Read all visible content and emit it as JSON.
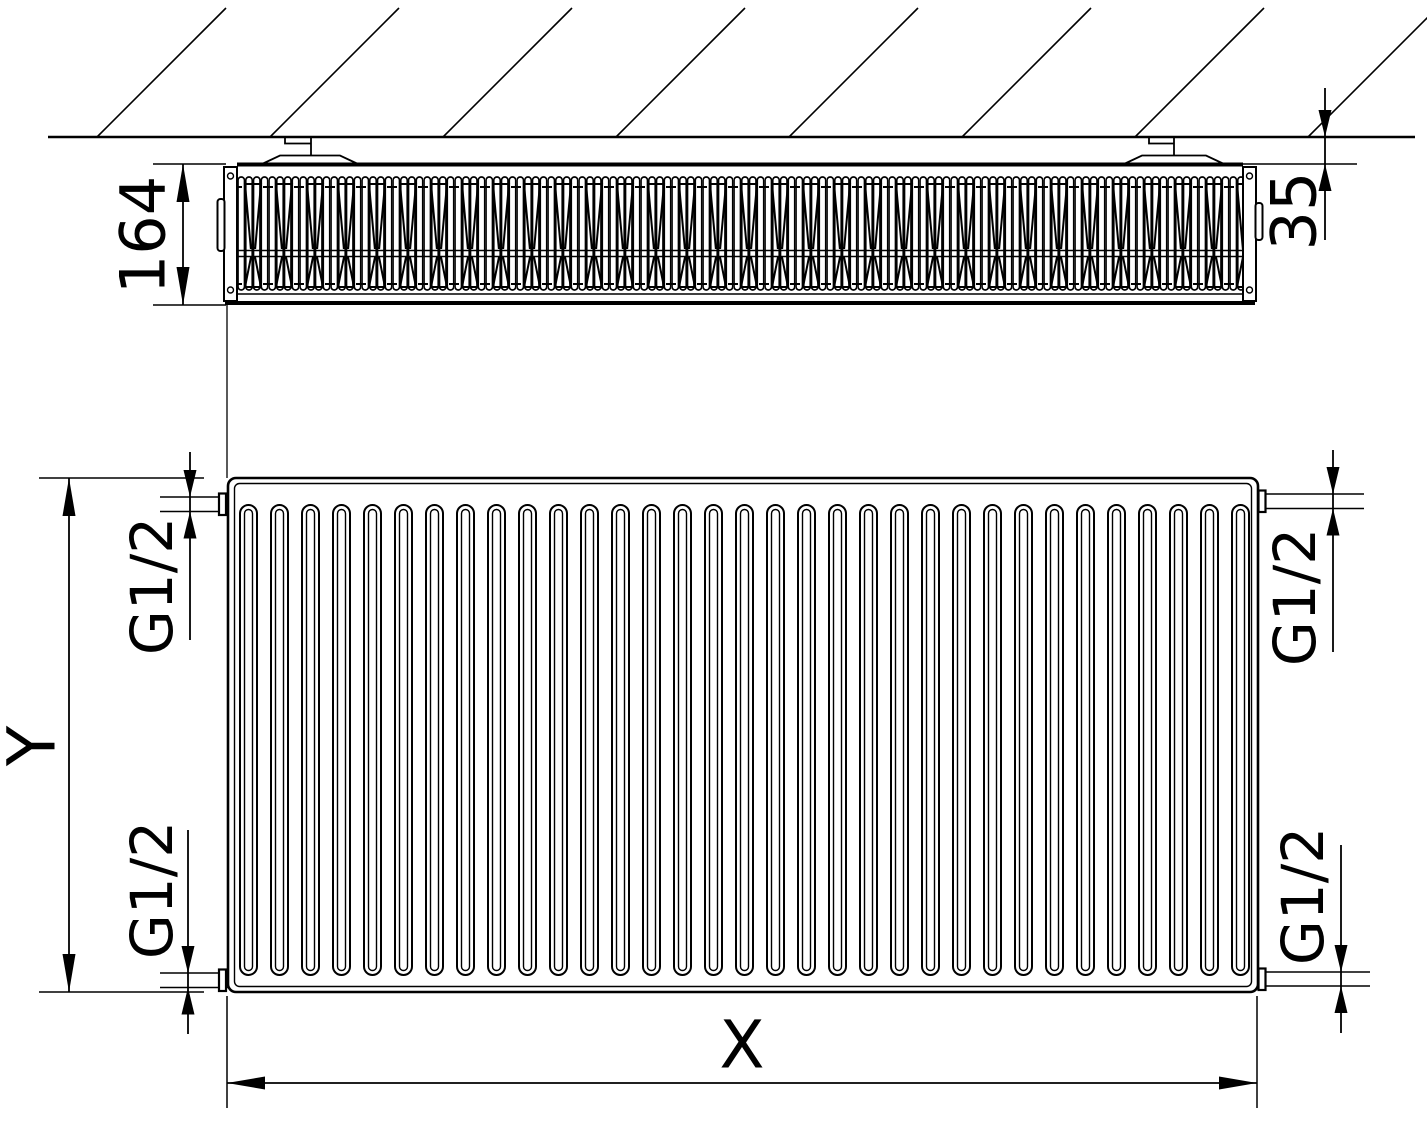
{
  "drawing": {
    "background": "#ffffff",
    "line_color": "#000000",
    "dimensions": {
      "depth": "164",
      "wall_clearance": "35",
      "height": "Y",
      "width": "X"
    },
    "connections": [
      {
        "position": "top-left",
        "label": "G1/2"
      },
      {
        "position": "bottom-left",
        "label": "G1/2"
      },
      {
        "position": "top-right",
        "label": "G1/2"
      },
      {
        "position": "bottom-right",
        "label": "G1/2"
      }
    ],
    "top_view": {
      "hatch_line_count": 8,
      "bracket_count": 2,
      "fin_unit_pitch": 31
    },
    "front_view": {
      "groove_count": 33,
      "connection_count": 4
    }
  }
}
